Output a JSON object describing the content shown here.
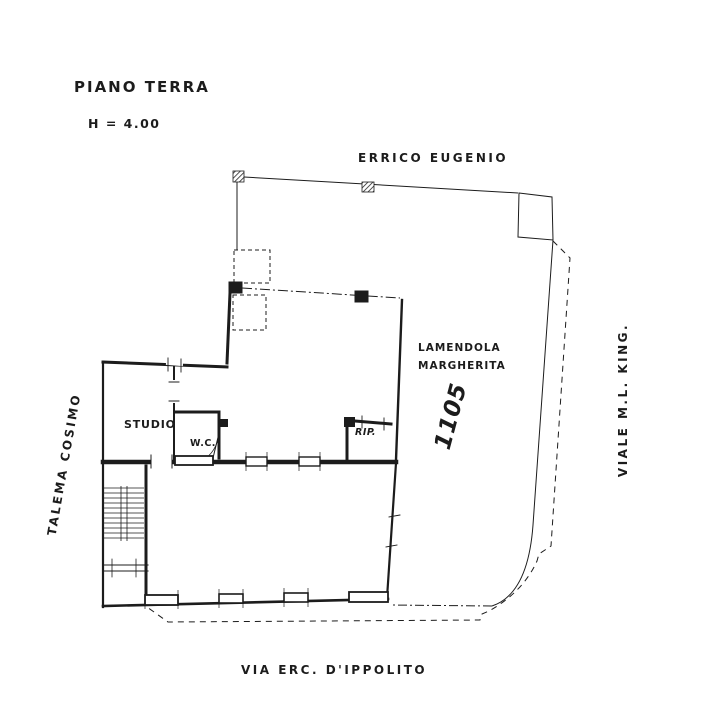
{
  "document": {
    "type": "floor-plan",
    "title": "PIANO TERRA",
    "height_note": "H = 4.00"
  },
  "colors": {
    "paper": "#ffffff",
    "ink": "#1c1c1c"
  },
  "boundaries": {
    "neighbor_top": "ERRICO EUGENIO",
    "neighbor_left": "TALEMA COSIMO",
    "street_right": "VIALE  M.L. KING.",
    "street_bottom": "VIA  ERC.  D'IPPOLITO"
  },
  "parcel": {
    "owner_line1": "LAMENDOLA",
    "owner_line2": "MARGHERITA",
    "number": "1105"
  },
  "rooms": [
    {
      "label": "STUDIO"
    },
    {
      "label": "W.C."
    },
    {
      "label": "RIP."
    }
  ]
}
